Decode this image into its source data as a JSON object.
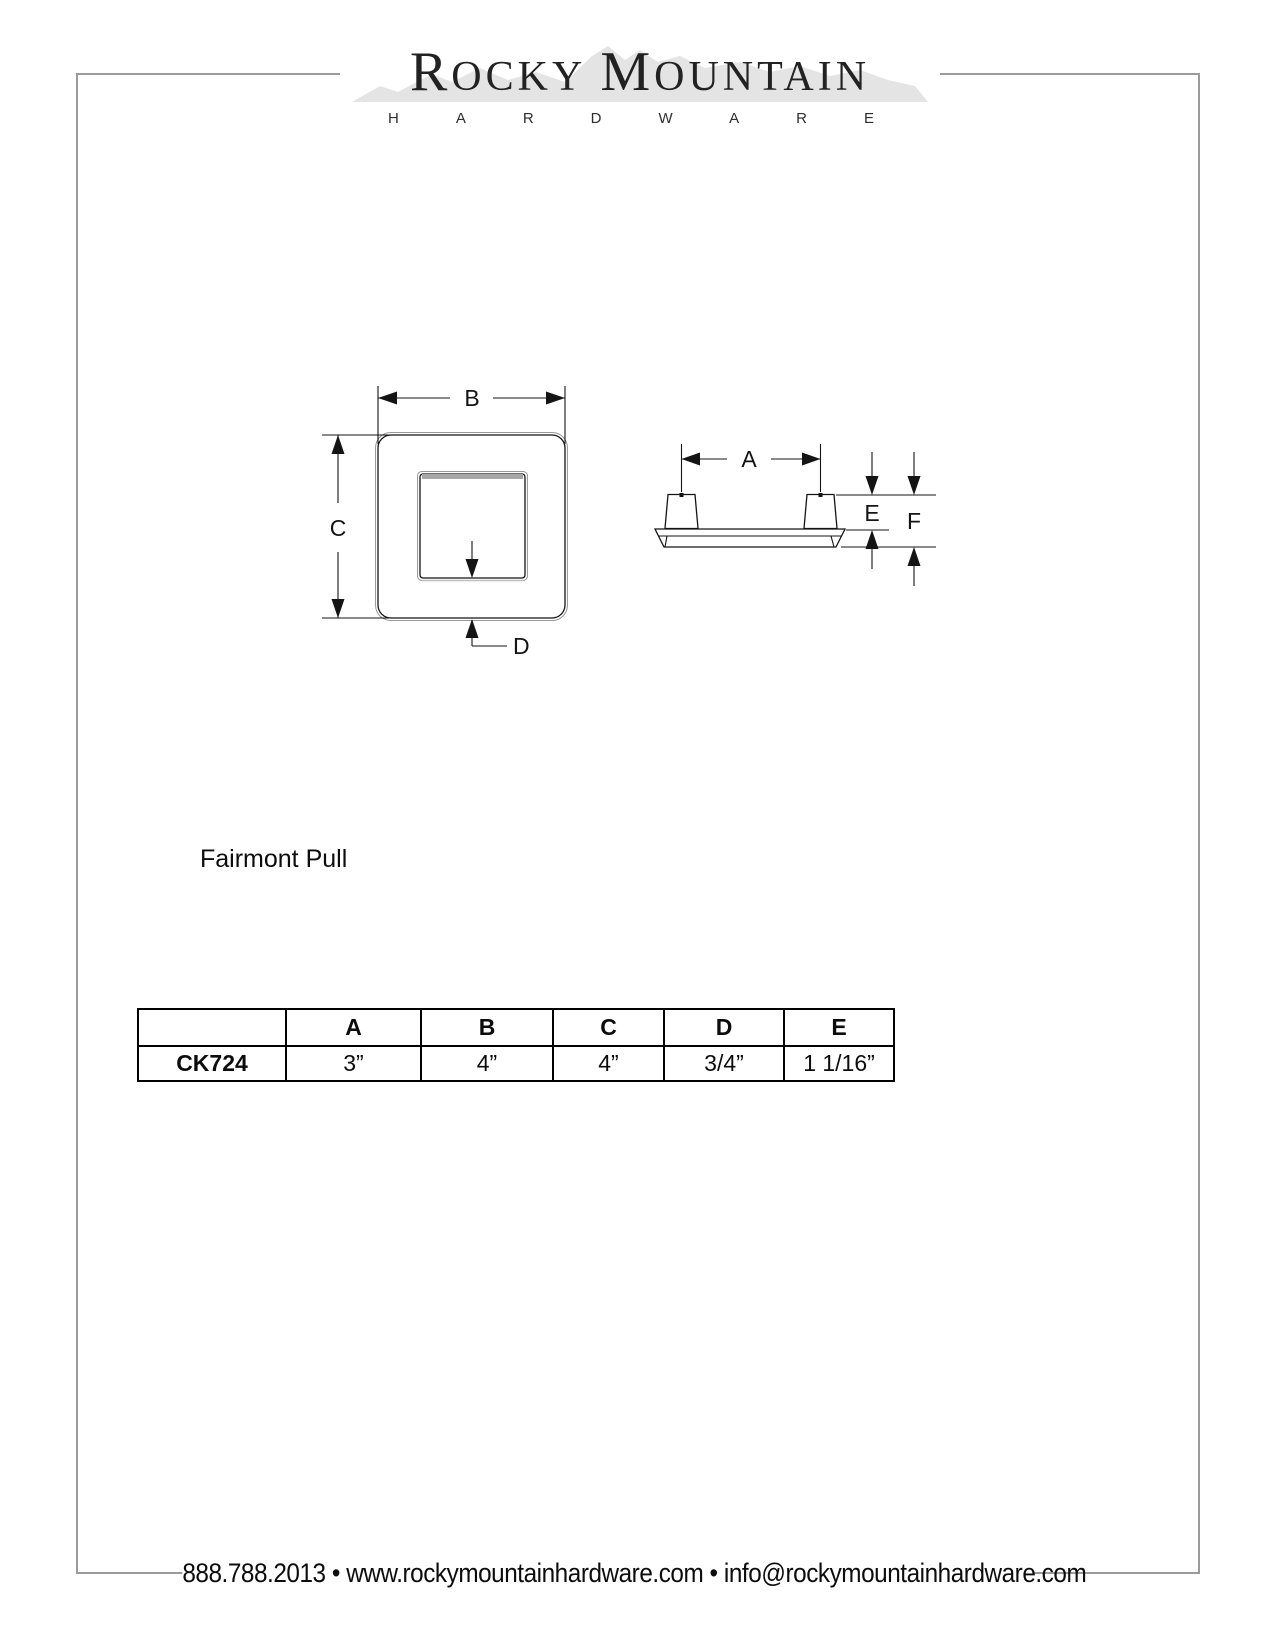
{
  "logo": {
    "word1_initial": "R",
    "word1_rest": "OCKY",
    "word2_initial": "M",
    "word2_rest": "OUNTAIN",
    "subtitle": "HARDWARE"
  },
  "product": {
    "name": "Fairmont Pull"
  },
  "diagram": {
    "labels": {
      "a": "A",
      "b": "B",
      "c": "C",
      "d": "D",
      "e": "E",
      "f": "F"
    }
  },
  "table": {
    "model_header": "",
    "headers": [
      "A",
      "B",
      "C",
      "D",
      "E"
    ],
    "row": {
      "model": "CK724",
      "a": "3”",
      "b": "4”",
      "c": "4”",
      "d": "3/4”",
      "e": "1 1/16”"
    }
  },
  "footer": {
    "contact_line": "888.788.2013 • www.rockymountainhardware.com • info@rockymountainhardware.com"
  },
  "colors": {
    "border_gray": "#9b9b9b",
    "mountain_gray": "#e4e4e4",
    "line_black": "#141414",
    "shade_gray": "#a6a6a6"
  }
}
